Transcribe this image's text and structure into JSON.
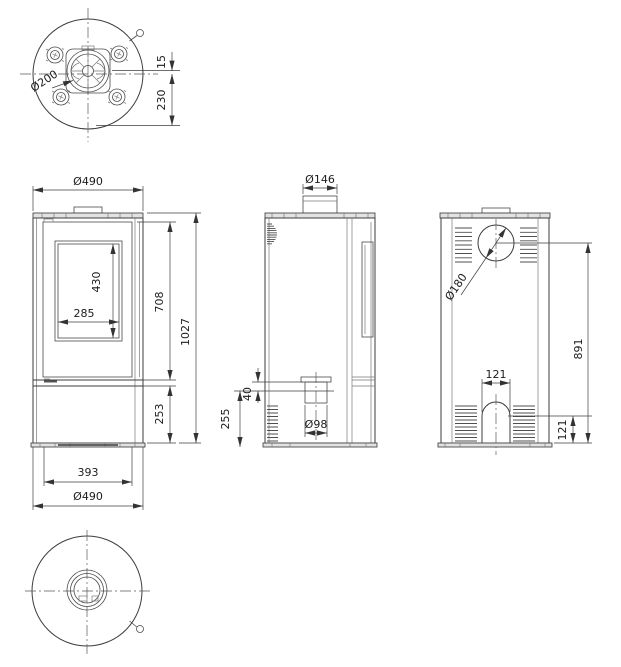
{
  "page": {
    "background": "#ffffff",
    "line_color": "#3d3d3d",
    "description": "Technical dimension drawing of a free-standing wood stove, five orthographic views"
  },
  "views": {
    "top": {
      "label": "top-view",
      "dims": {
        "flue_diameter": "Ø200",
        "flue_offset": "15",
        "flue_to_back": "230"
      }
    },
    "front": {
      "label": "front-view",
      "dims": {
        "width_top": "Ø490",
        "glass_height": "430",
        "glass_width": "285",
        "door_height": "708",
        "total_height": "1027",
        "base_height": "253",
        "body_width": "393",
        "width_bottom": "Ø490"
      }
    },
    "side": {
      "label": "side-view",
      "dims": {
        "collar_diameter": "Ø146",
        "inlet_offset": "40",
        "inlet_center_height": "255",
        "inlet_diameter": "Ø98"
      }
    },
    "back": {
      "label": "back-view",
      "dims": {
        "rear_flue_diameter": "Ø180",
        "flue_center_height": "891",
        "arch_width": "121",
        "arch_height": "121"
      }
    },
    "bottom": {
      "label": "bottom-view"
    }
  }
}
